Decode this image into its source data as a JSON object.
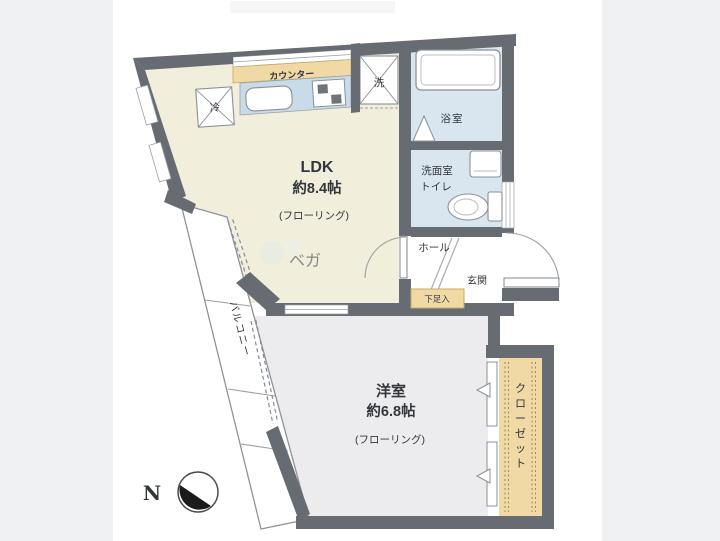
{
  "colors": {
    "background": "#eef0f1",
    "sheet": "#ffffff",
    "wall": "#676c73",
    "ldk_floor": "#f1eedb",
    "bedroom_floor": "#ececef",
    "wet_floor": "#d9e6f0",
    "kitchen_unit": "#c7dbe9",
    "tan": "#f1d9a6"
  },
  "plan": {
    "rooms": {
      "ldk": {
        "name": "LDK",
        "size": "約8.4帖",
        "floor": "(フローリング)"
      },
      "bedroom": {
        "name": "洋室",
        "size": "約6.8帖",
        "floor": "(フローリング)"
      },
      "bath": {
        "name": "浴室"
      },
      "washroom": {
        "line1": "洗面室",
        "line2": "トイレ"
      },
      "hall": {
        "name": "ホール"
      },
      "entrance": {
        "name": "玄関"
      },
      "shoe_box": {
        "name": "下足入"
      },
      "balcony": {
        "name": "バルコニー"
      },
      "closet": {
        "name": "クローゼット",
        "chars": [
          "ク",
          "ロ",
          "ー",
          "ゼ",
          "ッ",
          "ト"
        ]
      }
    },
    "kitchen": {
      "counter": "カウンター",
      "fridge": "冷",
      "washer": "洗"
    },
    "compass": {
      "label": "N"
    },
    "watermark": {
      "text": "ベガ"
    }
  }
}
